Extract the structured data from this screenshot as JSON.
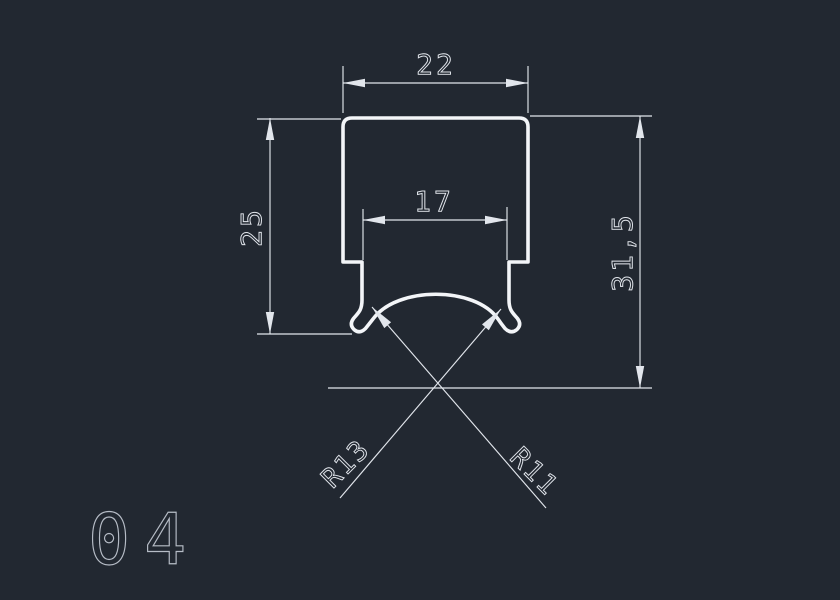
{
  "canvas": {
    "background": "#222831"
  },
  "drawing": {
    "part_label": "04",
    "colors": {
      "profile": "#f3f5f8",
      "dimension": "#e2e6ec",
      "label": "#b6bcc6"
    },
    "dimensions": {
      "top_width": "22",
      "inner_width": "17",
      "left_height": "25",
      "overall_height": "31,5",
      "radius_left_label": "R13",
      "radius_right_label": "R11"
    }
  }
}
